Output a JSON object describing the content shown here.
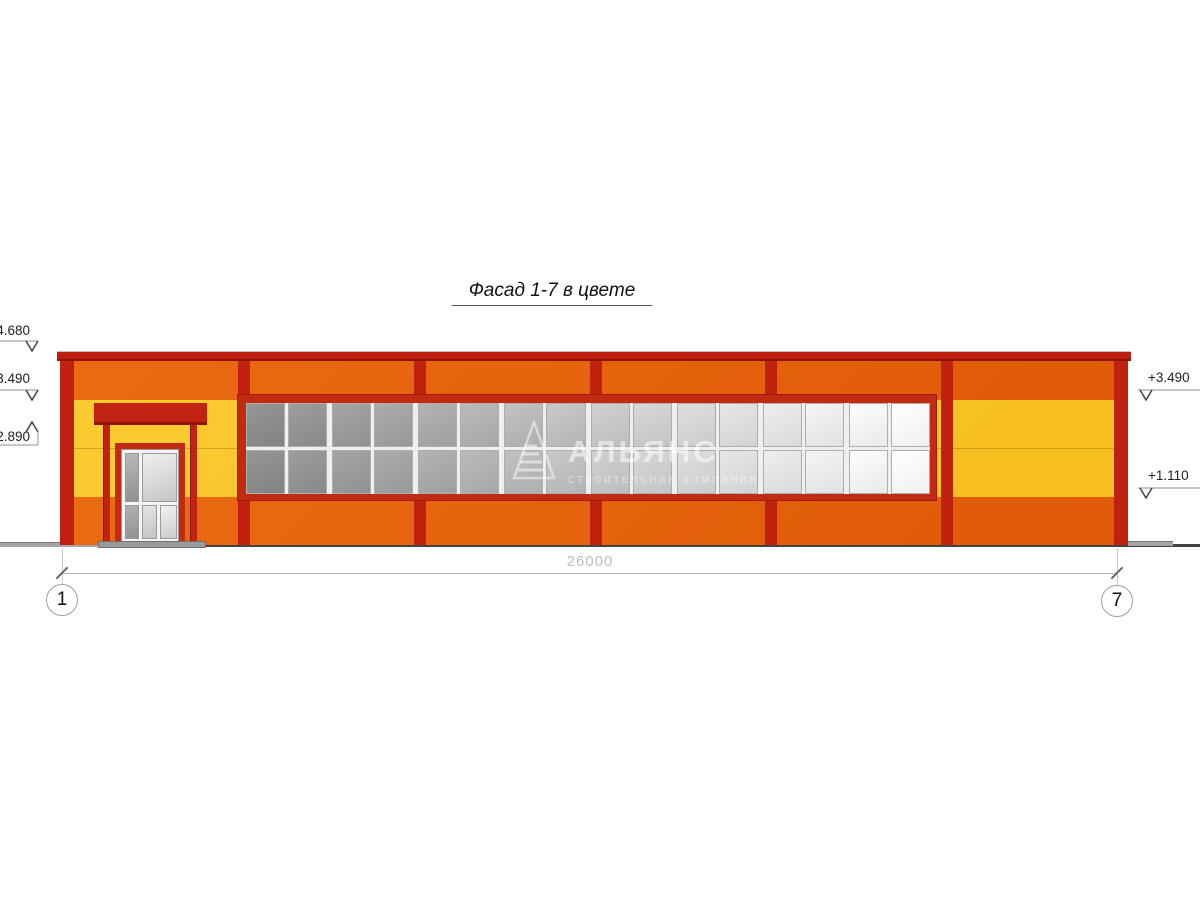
{
  "drawing": {
    "title": "Фасад 1-7 в цвете",
    "dimension_label": "26000",
    "axes": {
      "left": "1",
      "right": "7"
    },
    "elevations": {
      "left": [
        {
          "label": "4.680"
        },
        {
          "label": "3.490"
        },
        {
          "label": "2.890"
        }
      ],
      "right": [
        {
          "label": "+3.490"
        },
        {
          "label": "+1.110"
        }
      ]
    },
    "watermark": {
      "name": "АЛЬЯНС",
      "subtitle": "строительная компания"
    },
    "colors": {
      "orange": "#E5620D",
      "yellow": "#F9C627",
      "red": "#C2240F",
      "glass_dark": "#8C8C8C",
      "glass_light": "#FAFAFA",
      "ground": "#424242"
    },
    "window": {
      "rows": 2,
      "groups": 8,
      "panes_per_group": 2
    }
  }
}
